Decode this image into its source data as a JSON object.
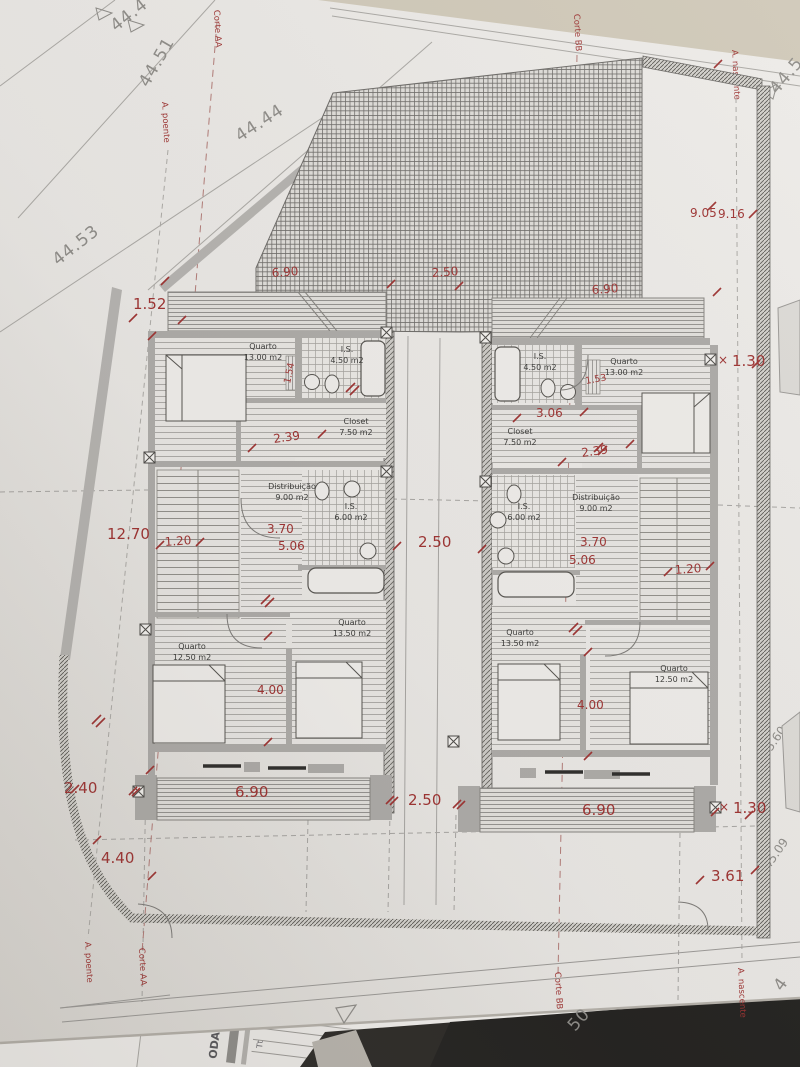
{
  "document_type": "architectural floor plan photo",
  "colors": {
    "annotation_red": "#9c3231",
    "paper": "#e9e7e4",
    "wall_grey": "#aba9a6",
    "line_grey": "#9a9895",
    "table_beige": "#cfc8b8",
    "dark_surface": "#2c2a27"
  },
  "plan": {
    "rooms": [
      {
        "name": "Quarto",
        "area": "13.00 m2"
      },
      {
        "name": "I.S.",
        "area": "4.50 m2"
      },
      {
        "name": "Closet",
        "area": "7.50 m2"
      },
      {
        "name": "Distribuição",
        "area": "9.00 m2"
      },
      {
        "name": "I.S.",
        "area": "6.00 m2"
      },
      {
        "name": "Quarto",
        "area": "13.50 m2"
      },
      {
        "name": "Quarto",
        "area": "12.50 m2"
      },
      {
        "name": "I.S.",
        "area": "4.50 m2"
      },
      {
        "name": "Quarto",
        "area": "13.00 m2"
      },
      {
        "name": "Closet",
        "area": "7.50 m2"
      },
      {
        "name": "Distribuição",
        "area": "9.00 m2"
      },
      {
        "name": "I.S.",
        "area": "6.00 m2"
      },
      {
        "name": "Quarto",
        "area": "13.50 m2"
      },
      {
        "name": "Quarto",
        "area": "12.50 m2"
      }
    ],
    "dimensions_red": [
      "1.52",
      "6.90",
      "2.50",
      "6.90",
      "9.05",
      "9.16",
      "1.30",
      "1.54",
      "1.53",
      "2.39",
      "3.06",
      "2.39",
      "12.70",
      "1.20",
      "3.70",
      "5.06",
      "2.50",
      "3.70",
      "5.06",
      "1.20",
      "4.00",
      "4.00",
      "2.40",
      "6.90",
      "2.50",
      "6.90",
      "1.30",
      "4.40",
      "3.61"
    ],
    "cross_marks": {
      "x1": "×",
      "x2": "×"
    },
    "sections": {
      "corte_aa": "Corte AA",
      "corte_bb": "Corte BB",
      "a_poente": "A. poente",
      "a_nascente": "A. nascente"
    },
    "elevations": {
      "top_cut": "44.4",
      "e4451": "44.51",
      "e4444": "44.44",
      "e4453": "44.53",
      "right_top": "44.5",
      "right_mid": "45.60",
      "right_low": "45.09",
      "bottom_50": "50",
      "right_partial": "4"
    },
    "underlying_doc": {
      "text1": "ODA",
      "text2": "Tt"
    }
  }
}
